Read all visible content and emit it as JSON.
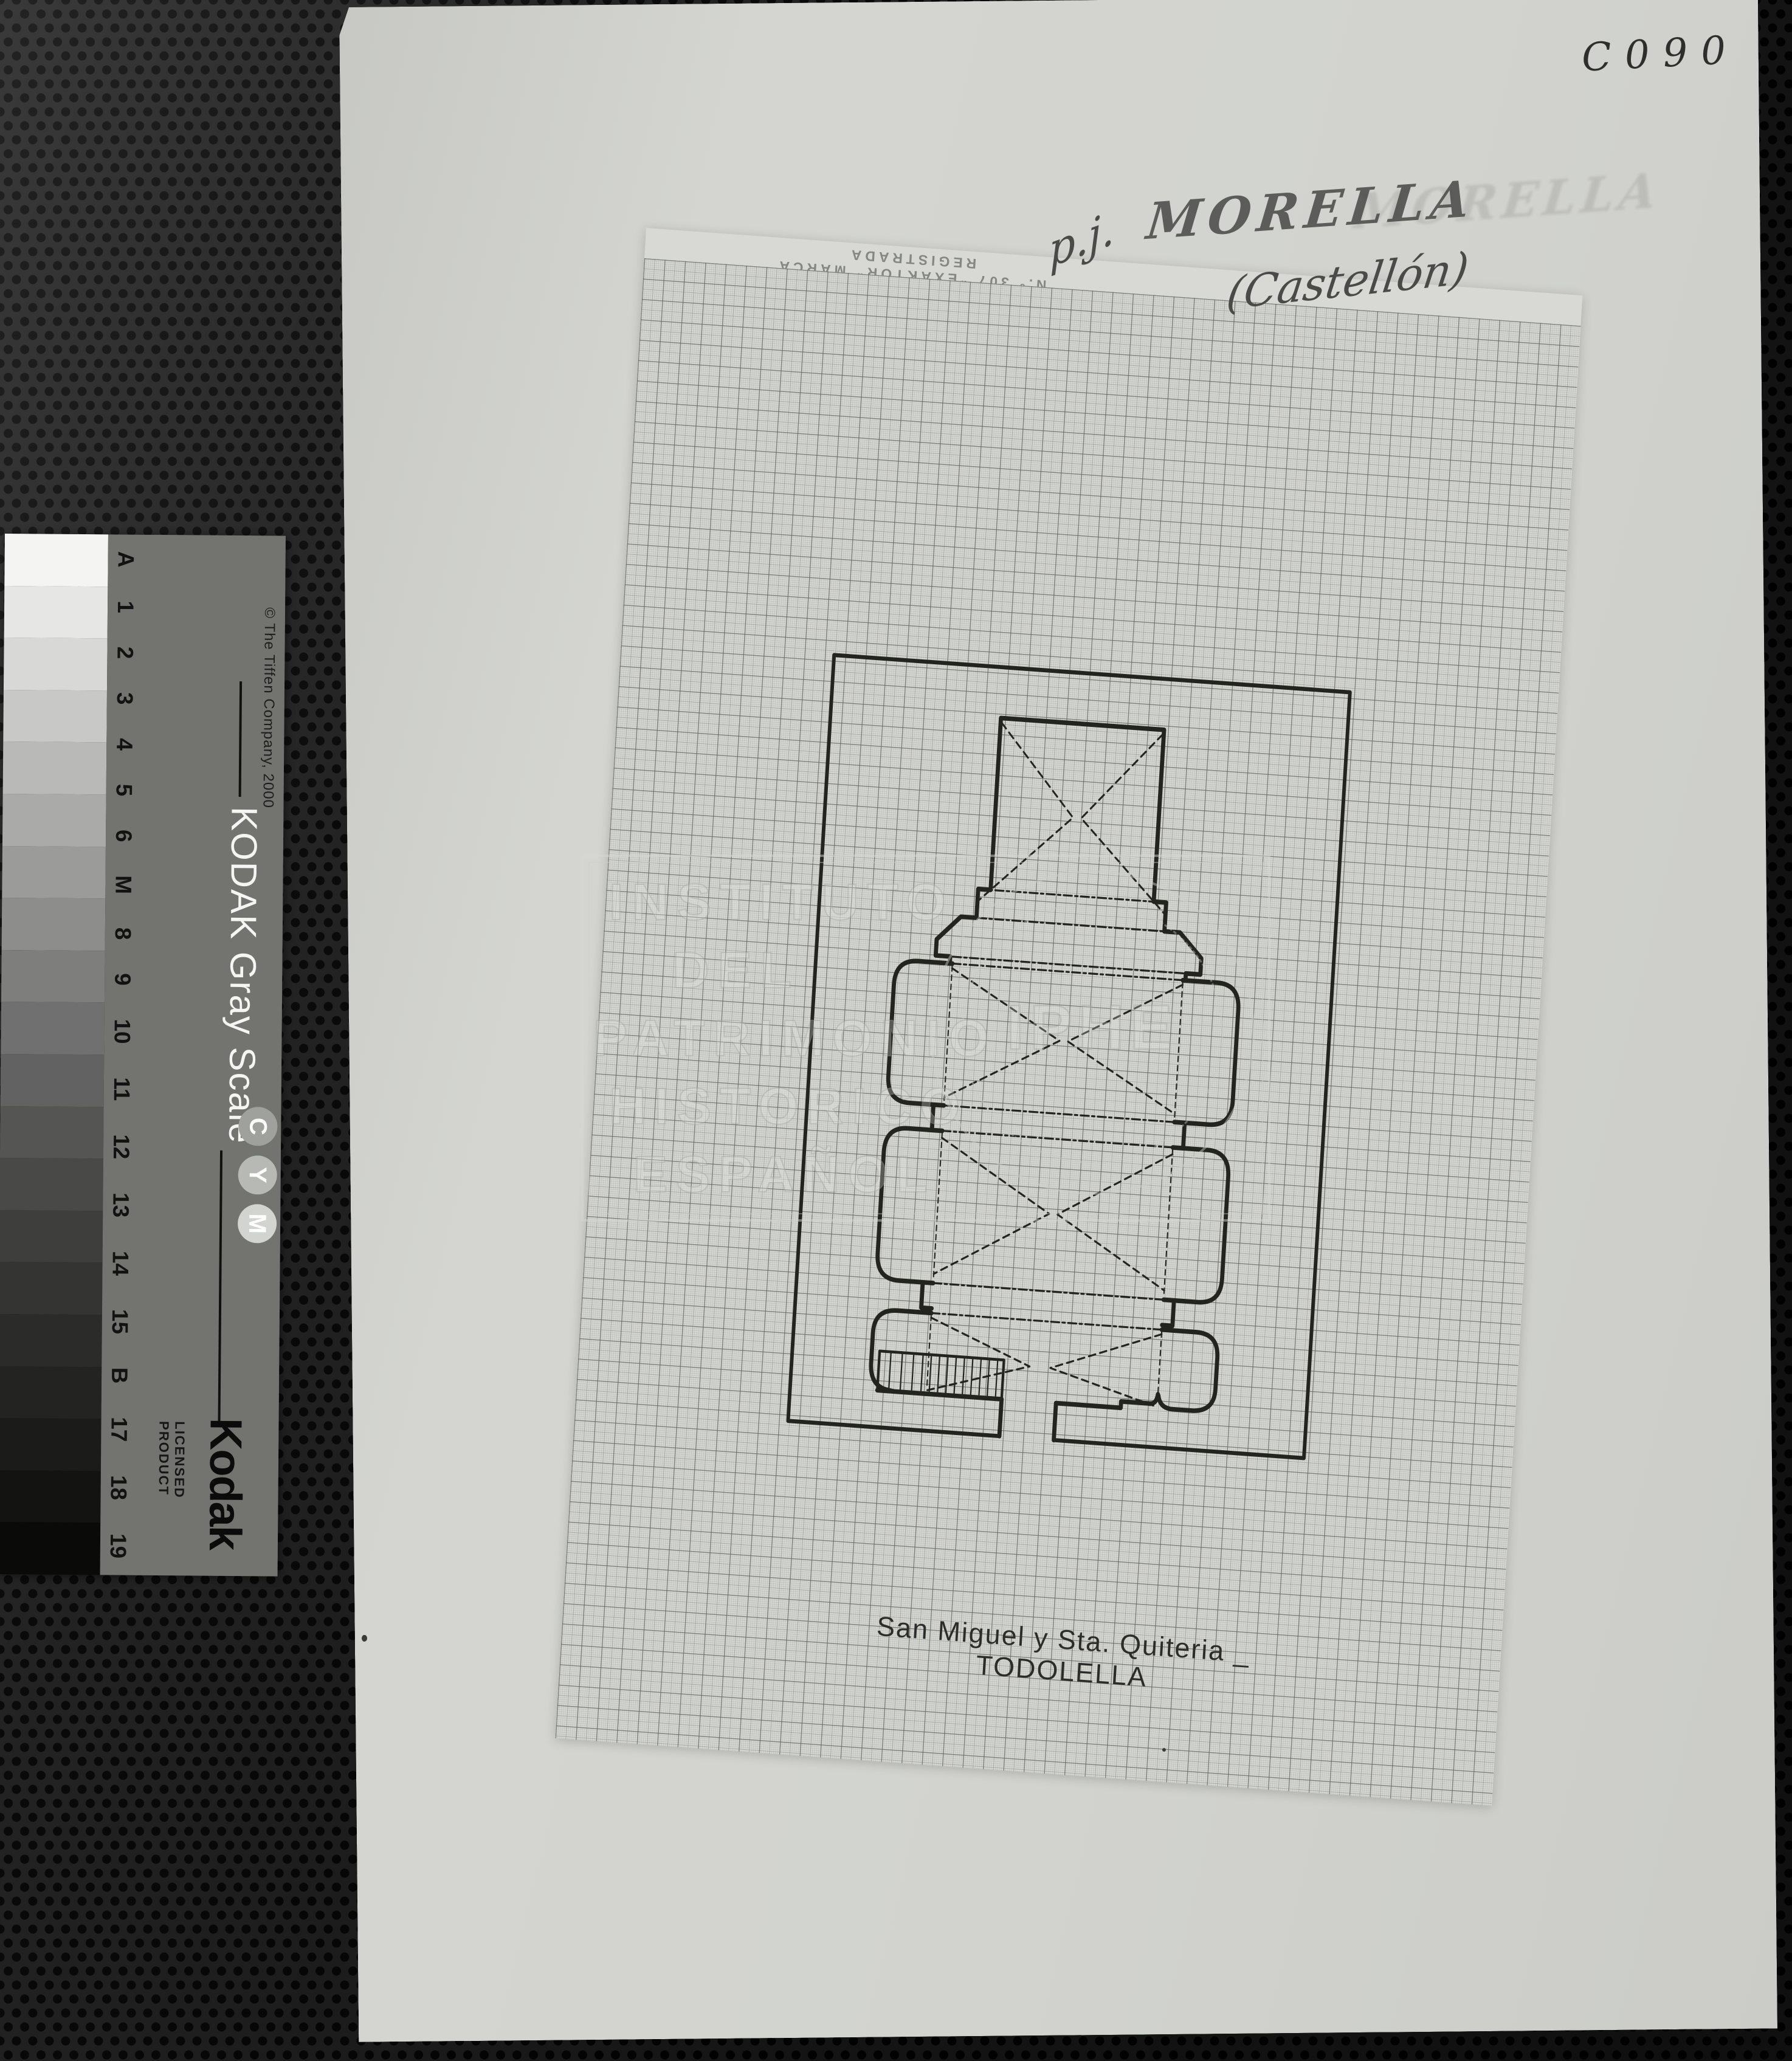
{
  "annotations": {
    "code": "C090",
    "abbrev": "p.j.",
    "place": "MORELLA",
    "place_ghost": "MORELLA",
    "province": "(Castellón)"
  },
  "graph_sheet": {
    "brand_line": "N.º 307 \"EXAKTOR\" MARCA REGISTRADA",
    "plan_title": "San Miguel y Sta. Quiteria _ TODOLELLA"
  },
  "watermark": {
    "line1": "INSTITUTO",
    "line2": "DEL",
    "line3": "PATRIMONIO",
    "line4": "HISTORICO",
    "line5": "ESPAÑOL",
    "seal": "IPHE"
  },
  "gray_scale": {
    "copyright": "© The Tiffen Company, 2000",
    "scale_name": "KODAK Gray Scale",
    "index_labels": [
      "A",
      "1",
      "2",
      "3",
      "4",
      "5",
      "6",
      "M",
      "8",
      "9",
      "10",
      "11",
      "12",
      "13",
      "14",
      "15",
      "B",
      "17",
      "18",
      "19"
    ],
    "cym_letters": [
      "C",
      "Y",
      "M"
    ],
    "cym_bg": [
      "#9fa19d",
      "#b7b9b5",
      "#d2d4d0"
    ],
    "brand": "Kodak",
    "licensed": "LICENSED PRODUCT",
    "label_bg": "#73746f",
    "patches": [
      "#f4f4f2",
      "#e6e6e4",
      "#d8d8d6",
      "#c8c8c6",
      "#b9b9b7",
      "#aaaaa8",
      "#9b9b99",
      "#8d8d8b",
      "#7e7e7c",
      "#707070",
      "#626262",
      "#555553",
      "#494947",
      "#3e3e3c",
      "#343432",
      "#2b2b29",
      "#232321",
      "#1b1b19",
      "#131311",
      "#0a0a08"
    ]
  },
  "colors": {
    "background": "#1c1c1c",
    "paper": "#d2d3cf",
    "graph_paper": "#d7d8d3",
    "ink": "#24241f",
    "pencil": "#4c4c4a",
    "watermark_gray": "#c9cbc5"
  }
}
